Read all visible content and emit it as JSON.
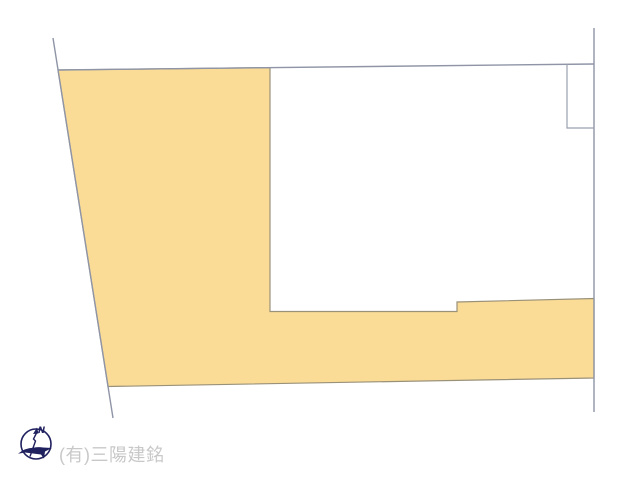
{
  "diagram": {
    "kind": "land-plot-site-diagram",
    "compass": {
      "north_label": "N"
    },
    "watermark": {
      "company_name": "(有)三陽建銘"
    }
  },
  "colors": {
    "background": "#ffffff",
    "parcel_fill": "#fadc96",
    "parcel_outline": "#9a9179",
    "boundary_line": "#8f95a6",
    "inner_outline": "#9aa0ae",
    "compass_navy": "#20215f",
    "watermark_gray": "#c8c8c8"
  }
}
